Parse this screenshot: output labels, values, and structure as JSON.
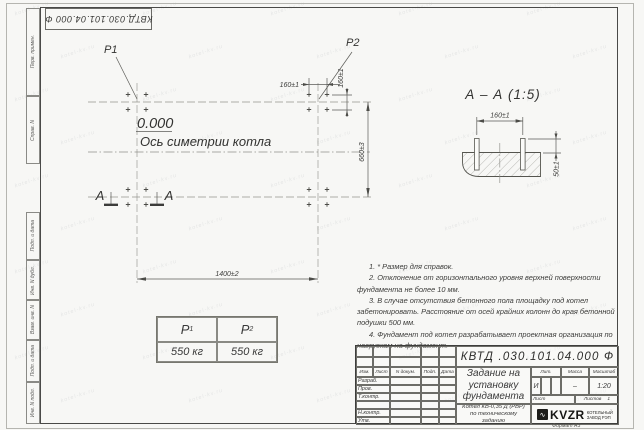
{
  "stamp_top": {
    "designation": "КВТД.030.101.04.000 Ф"
  },
  "margin": {
    "labels": [
      "Перв. примен.",
      "Справ. N",
      "Подп. и дата",
      "Инв. N дубл.",
      "Взам. инв. N",
      "Подп. и дата",
      "Инв. N подл."
    ]
  },
  "plan": {
    "p1": "P1",
    "p2": "P2",
    "level": "0.000",
    "axis_label": "Ось симетрии котла",
    "section_letter_left": "А",
    "section_letter_right": "А",
    "dim_160_top": "160±1",
    "dim_160_right": "160±1",
    "dim_660": "660±3",
    "dim_1400": "1400±2"
  },
  "section": {
    "title": "А – А (1:5)",
    "dim_160": "160±1",
    "dim_50": "50±1"
  },
  "loads_table": {
    "col1_header": "P",
    "col1_sub": "1",
    "col2_header": "P",
    "col2_sub": "2",
    "col1_value": "550 кг",
    "col2_value": "550 кг"
  },
  "notes": [
    "1. * Размер для справок.",
    "2. Отклонение от горизонтального уровня верхней поверхности фундамента не более 10 мм.",
    "3. В случае отсутствия бетонного пола площадку под котел забетонировать. Расстояние от осей крайних колонн до края бетонной подушки 500 мм.",
    "4. Фундамент под котел разрабатывает проектная организация по нагрузкам на фундамент."
  ],
  "title_block": {
    "designation": "КВТД .030.101.04.000 Ф",
    "doc_title": "Задание на установку фундамента",
    "product_note": "Котел КВ-0,35 Д (РВР) по техническому заданию",
    "change_header": [
      "Изм.",
      "Лист",
      "N докум.",
      "Подп.",
      "Дата"
    ],
    "signature_rows": [
      "Разраб.",
      "Пров.",
      "Т.контр.",
      "",
      "Н.контр.",
      "Утв."
    ],
    "lit_label": "Лит.",
    "lit_value": "И",
    "mass_label": "Масса",
    "mass_value": "–",
    "scale_label": "Масштаб",
    "scale_value": "1:20",
    "sheet_label": "Лист",
    "sheets_label": "Листов",
    "sheets_value": "1",
    "company_logo": "KVZR",
    "company_line1": "КОТЕЛЬНЫЙ",
    "company_line2": "ЗАВОД РЭП",
    "format": "Формат А3"
  },
  "watermark": {
    "text": "kotel-kv.ru"
  }
}
